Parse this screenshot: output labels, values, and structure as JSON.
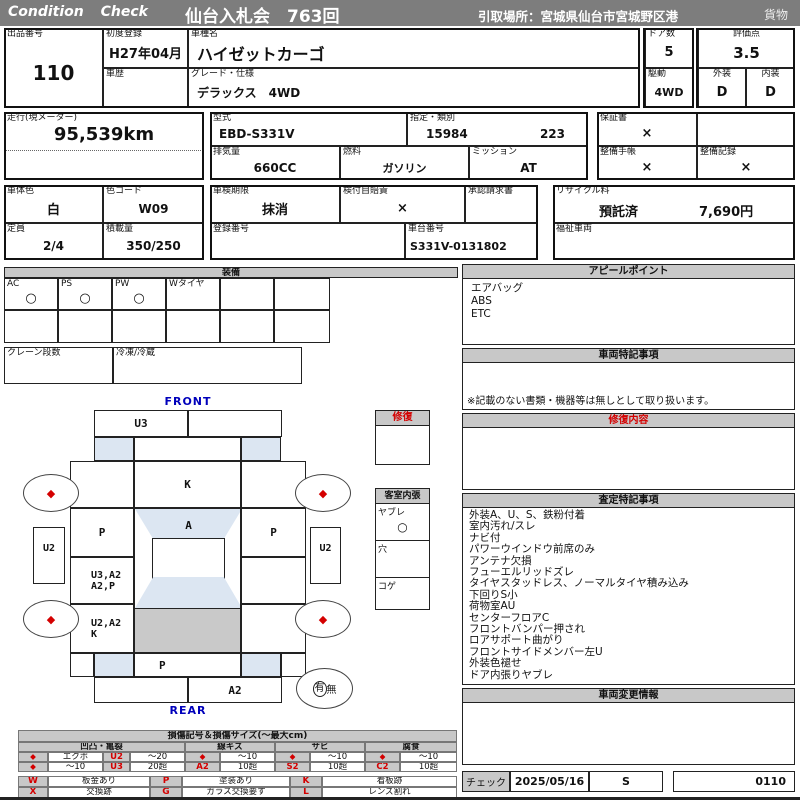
{
  "colors": {
    "header_gray": "#7d7d7d",
    "band_gray": "#c8c8c8",
    "accent_red": "#d40000",
    "blue_label": "#0000bb",
    "light_blue": "#dce6f2",
    "cargo_gray": "#c9c9c9"
  },
  "hdr": {
    "brand": "Condition Check",
    "title": "仙台入札会　763回",
    "pickup": "引取場所：宮城県仙台市宮城野区港",
    "cargo": "貨物"
  },
  "f": {
    "lot": {
      "l": "出品番号",
      "v": "110"
    },
    "reg": {
      "l": "初度登録",
      "v": "H27年04月"
    },
    "hist": {
      "l": "車歴",
      "v": ""
    },
    "model": {
      "l": "車種名",
      "v": "ハイゼットカーゴ"
    },
    "grade": {
      "l": "グレード・仕様",
      "v": "デラックス　4WD"
    },
    "doors": {
      "l": "ドア数",
      "v": "5"
    },
    "drive": {
      "l": "駆動",
      "v": "4WD"
    },
    "score": {
      "l": "評価点",
      "v": "3.5"
    },
    "ext": {
      "l": "外装",
      "v": "D"
    },
    "intr": {
      "l": "内装",
      "v": "D"
    },
    "mileage": {
      "l": "走行(現メーター)",
      "v": "95,539km"
    },
    "mcode": {
      "l": "型式",
      "v": "EBD-S331V"
    },
    "cls": {
      "l": "指定・類別",
      "v1": "15984",
      "v2": "223"
    },
    "disp": {
      "l": "排気量",
      "v": "660CC"
    },
    "fuel": {
      "l": "燃料",
      "v": "ガソリン"
    },
    "mission": {
      "l": "ミッション",
      "v": "AT"
    },
    "warranty": {
      "l": "保証書",
      "v": "×"
    },
    "maint_book": {
      "l": "整備手帳",
      "v": "×"
    },
    "maint_rec": {
      "l": "整備記録",
      "v": "×"
    },
    "bodycolor": {
      "l": "車体色",
      "v": "白"
    },
    "colorcode": {
      "l": "色コード",
      "v": "W09"
    },
    "shaken": {
      "l": "車検期限",
      "v": "抹消"
    },
    "jibai": {
      "l": "検付自賠責",
      "v": "×"
    },
    "approval": {
      "l": "承認請求書",
      "v": ""
    },
    "recycle": {
      "l": "リサイクル料",
      "v1": "預託済",
      "v2": "7,690円"
    },
    "capacity": {
      "l": "定員",
      "v": "2/4"
    },
    "load": {
      "l": "積載量",
      "v": "350/250"
    },
    "regno": {
      "l": "登録番号",
      "v": ""
    },
    "chassis": {
      "l": "車台番号",
      "v": "S331V-0131802"
    },
    "welfare": {
      "l": "福祉車両",
      "v": ""
    }
  },
  "equip": {
    "title": "装備",
    "c1": {
      "l": "AC",
      "v": "○"
    },
    "c2": {
      "l": "PS",
      "v": "○"
    },
    "c3": {
      "l": "PW",
      "v": "○"
    },
    "c4": {
      "l": "Wタイヤ",
      "v": ""
    },
    "crane": "クレーン段数",
    "freezer": "冷凍/冷蔵"
  },
  "diag": {
    "front": "FRONT",
    "rear": "REAR",
    "u3": "U3",
    "k": "K",
    "p_left": "P",
    "a": "A",
    "p_right": "P",
    "u2_left": "U2",
    "u2_right": "U2",
    "mid_left1": "U3,A2",
    "mid_left2": "A2,P",
    "low_left1": "U2,A2",
    "low_left2": "K",
    "rear_p": "P",
    "rear_bumper": "A2",
    "wheel_mark": "◆",
    "spare_has": "有",
    "spare_none": "無"
  },
  "repair_small": {
    "title": "修復"
  },
  "cabin": {
    "title": "客室内張",
    "r1l": "ヤブレ",
    "r1v": "○",
    "r2l": "穴",
    "r2v": "",
    "r3l": "コゲ",
    "r3v": ""
  },
  "appeal": {
    "title": "アピールポイント",
    "items": [
      "エアバッグ",
      "ABS",
      "ETC"
    ]
  },
  "notes": {
    "title": "車両特記事項",
    "foot": "※記載のない書類・機器等は無しとして取り扱います。"
  },
  "repair_content": {
    "title": "修復内容"
  },
  "assess": {
    "title": "査定特記事項",
    "items": [
      "外装A、U、S、鉄粉付着",
      "室内汚れ/スレ",
      "ナビ付",
      "パワーウインドウ前席のみ",
      "アンテナ欠損",
      "フューエルリッドズレ",
      "タイヤスタッドレス、ノーマルタイヤ積み込み",
      "下回りS小",
      "荷物室AU",
      "センターフロアC",
      "フロントバンパー押され",
      "ロアサポート曲がり",
      "フロントサイドメンバー左U",
      "外装色褪せ",
      "ドア内張りヤブレ"
    ]
  },
  "change_info": {
    "title": "車両変更情報"
  },
  "check": {
    "label": "チェック",
    "date": "2025/05/16",
    "grade": "S",
    "code": "0110"
  },
  "legend": {
    "title": "損傷記号＆損傷サイズ(〜最大cm)",
    "group_names": [
      "凹凸・亀裂",
      "線キズ",
      "サビ",
      "腐食"
    ],
    "diamond": "◆",
    "dent": {
      "r1_label": "エクボ",
      "r1_code": "U2",
      "r1_size": "〜20",
      "r2_label": "〜10",
      "r2_code": "U3",
      "r2_size": "20超"
    },
    "scratch": {
      "r1_size": "〜10",
      "r2_code": "A2",
      "r2_size": "10超"
    },
    "rust": {
      "r1_size": "〜10",
      "r2_code": "S2",
      "r2_size": "10超"
    },
    "corrosion": {
      "r1_size": "〜10",
      "r2_code": "C2",
      "r2_size": "10超"
    },
    "codes": [
      {
        "sym": "W",
        "label": "板金あり"
      },
      {
        "sym": "P",
        "label": "塗装あり"
      },
      {
        "sym": "K",
        "label": "看板跡"
      },
      {
        "sym": "X",
        "label": "交換跡"
      },
      {
        "sym": "G",
        "label": "ガラス交換要す"
      },
      {
        "sym": "L",
        "label": "レンズ割れ"
      }
    ]
  }
}
